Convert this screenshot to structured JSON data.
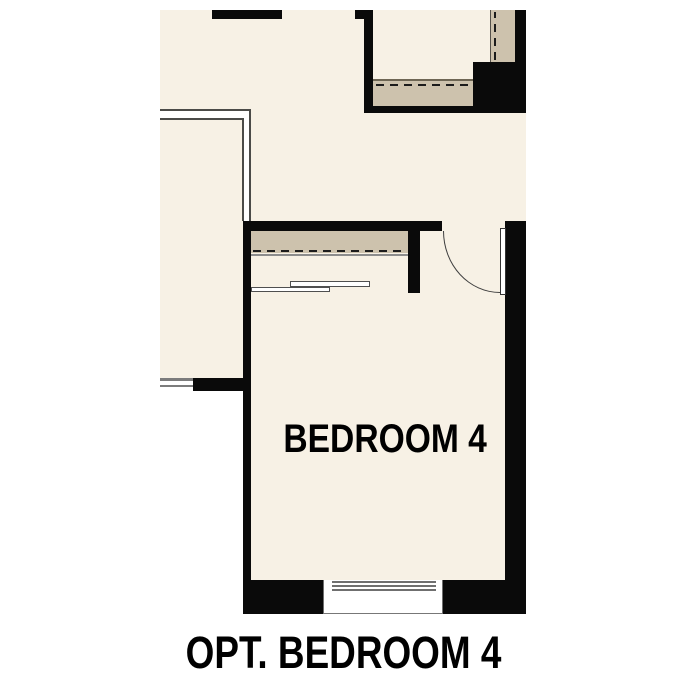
{
  "plan": {
    "room_label": "BEDROOM 4",
    "caption": "OPT. BEDROOM 4"
  },
  "colors": {
    "background": "#ffffff",
    "floor": "#f7f1e5",
    "wall": "#0a0a0a",
    "closet_shelf_tan": "#cdc2ad",
    "shelf_edge_dark": "#6e6654",
    "thin_line": "#4b4b48",
    "window_line_gray": "#7c7c7c",
    "text": "#000000"
  },
  "features": {
    "door": "hinged door with quarter-circle swing arc",
    "closet_top": "wardrobe with dashed rod line and tan shelf band",
    "closet_upper": "closet with dashed rod line and tan shelf band",
    "linen": "shelved nook with vertical dashed line",
    "window_bottom": "exterior window in bottom wall",
    "window_left": "exterior window in left room wall",
    "open_walls": "unfilled reference walls (double thin lines)"
  }
}
